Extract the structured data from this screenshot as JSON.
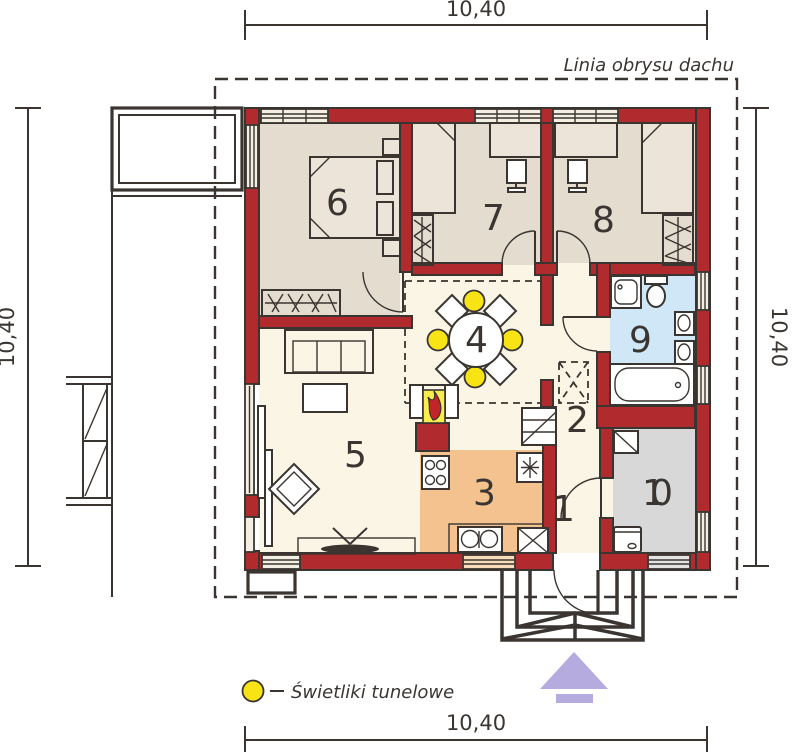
{
  "dimensions": {
    "top": "10,40",
    "bottom": "10,40",
    "left": "10,40",
    "right": "10,40"
  },
  "labels": {
    "roof_outline": "Linia obrysu dachu",
    "legend": "Świetliki tunelowe"
  },
  "rooms": {
    "r1": "1",
    "r2": "2",
    "r3": "3",
    "r4": "4",
    "r5": "5",
    "r6": "6",
    "r7": "7",
    "r8": "8",
    "r9": "9",
    "r10": "10"
  },
  "colors": {
    "line": "#3a3531",
    "wall": "#b12a2d",
    "cream": "#fbf5e5",
    "beige": "#e5dcd0",
    "blue": "#cfe7f7",
    "gray": "#d8d8d8",
    "orange": "#f4c28e",
    "window": "#f4efe3",
    "furn": "#ece4d8",
    "yellow": "#f8e414",
    "fireyellow": "#f9ed4e",
    "flame": "#c3242a",
    "purple": "#b5abdf"
  }
}
